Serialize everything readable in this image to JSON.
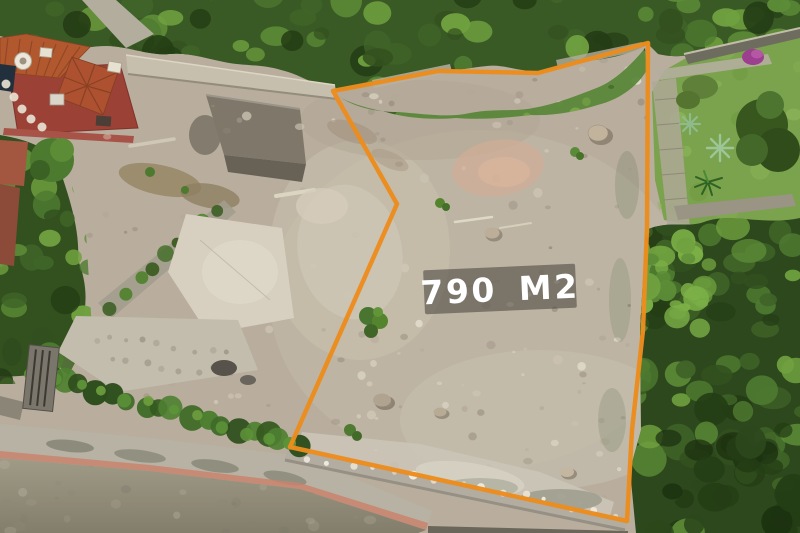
{
  "annotation": {
    "area_label": "790 M2",
    "outline_color": "#EC8C1E",
    "outline_points": "333,91 438,71 538,73 648,43 647,227 643,330 632,430 627,521 290,447 397,204",
    "label_background": "rgba(55,52,48,0.5)",
    "label_text_color": "#FFFFFF"
  },
  "scene": {
    "type": "aerial-drone-photo",
    "subject": "Cleared vacant land plot outlined in orange, bordered by trees, a terracotta tile-roof house, a neighboring garden and a street with a pink curb"
  }
}
